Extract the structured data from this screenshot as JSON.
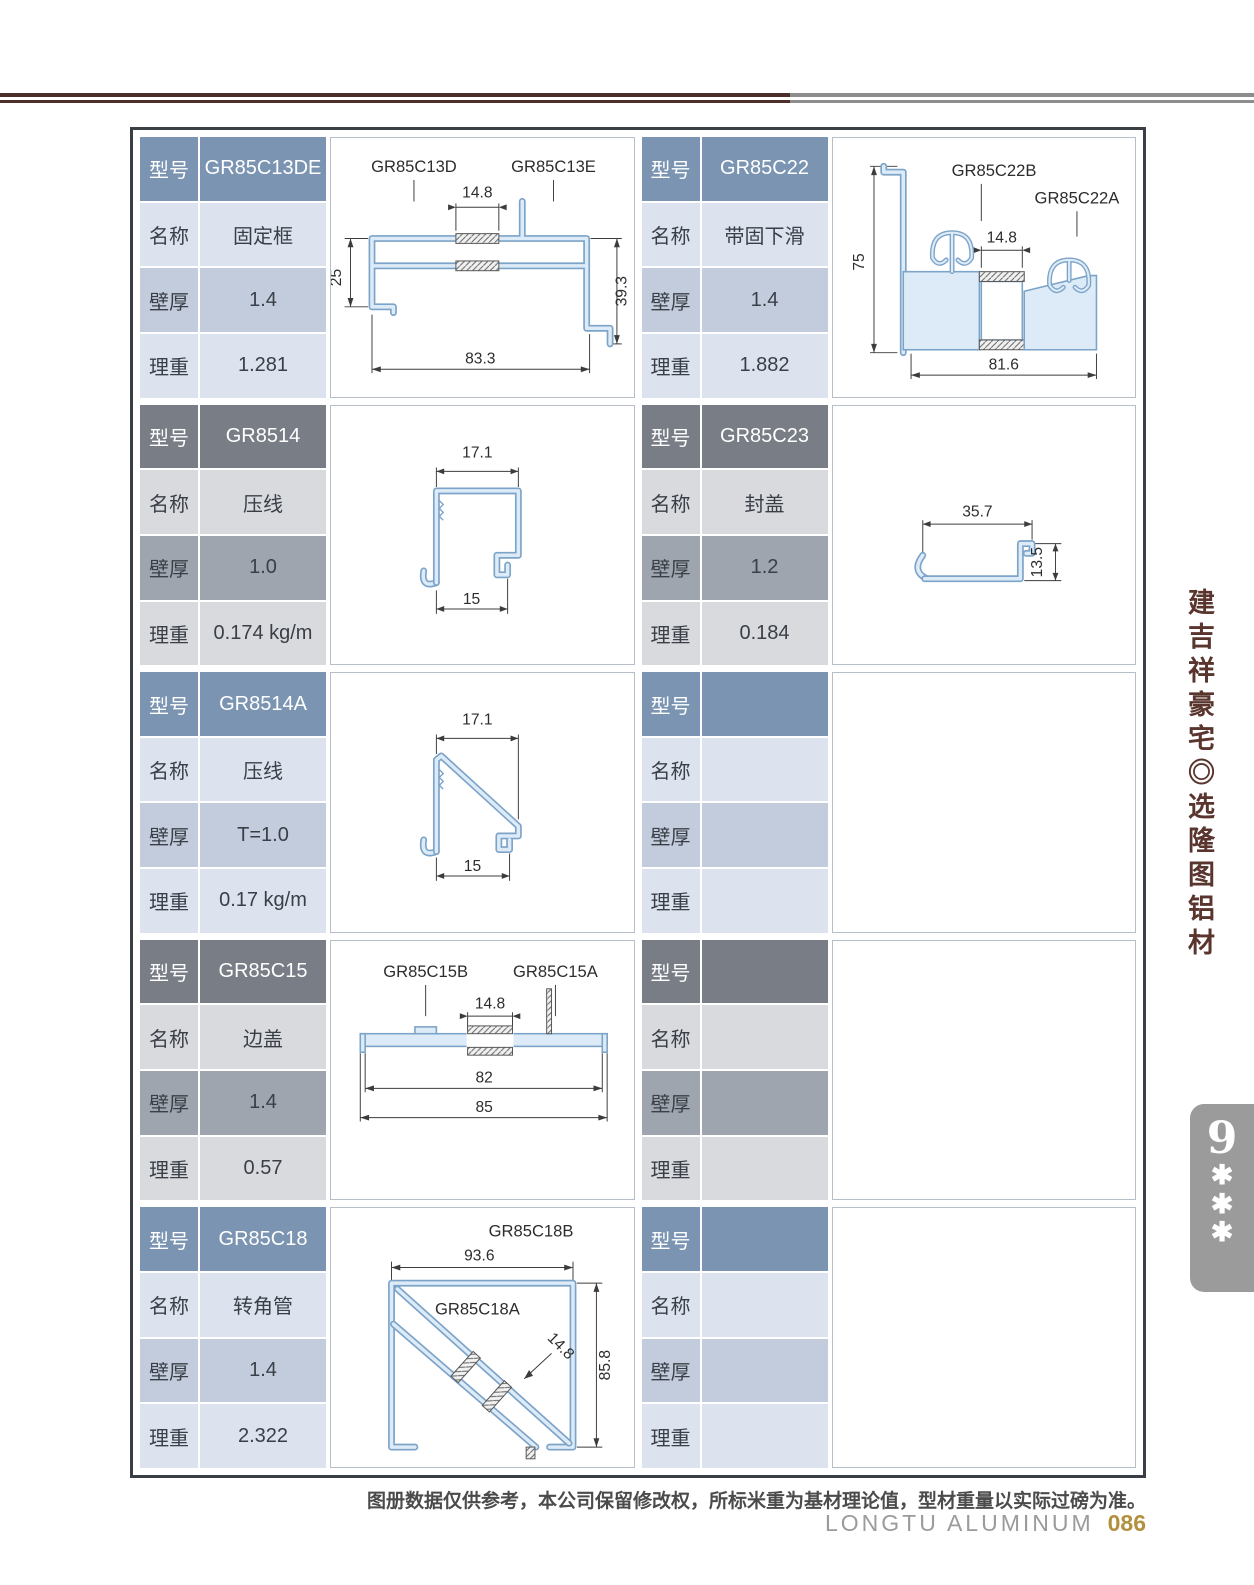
{
  "header": {
    "title_cn": "GR85C 系列隔热节能推拉窗型材图",
    "title_en": "GR85C series insulation energy-saving push-pull window profile graph",
    "brand_cn": "隆图",
    "brand_suffix": "节能铝材",
    "brand_en": "LONGTU ENERGY-SAVING ALUMINUM"
  },
  "labels": {
    "model": "型号",
    "name": "名称",
    "thickness": "壁厚",
    "weight": "理重"
  },
  "cells": [
    {
      "theme": "blue",
      "model": "GR85C13DE",
      "name": "固定框",
      "thickness": "1.4",
      "weight": "1.281",
      "drawing": {
        "label_left": "GR85C13D",
        "label_right": "GR85C13E",
        "dim_top": "14.8",
        "dim_left": "25",
        "dim_right": "39.3",
        "dim_bottom": "83.3"
      }
    },
    {
      "theme": "blue",
      "model": "GR85C22",
      "name": "带固下滑",
      "thickness": "1.4",
      "weight": "1.882",
      "drawing": {
        "label_left": "GR85C22B",
        "label_right": "GR85C22A",
        "dim_left": "75",
        "dim_mid": "14.8",
        "dim_bottom": "81.6"
      }
    },
    {
      "theme": "gray",
      "model": "GR8514",
      "name": "压线",
      "thickness": "1.0",
      "weight": "0.174 kg/m",
      "drawing": {
        "dim_top": "17.1",
        "dim_bottom": "15"
      }
    },
    {
      "theme": "gray",
      "model": "GR85C23",
      "name": "封盖",
      "thickness": "1.2",
      "weight": "0.184",
      "drawing": {
        "dim_top": "35.7",
        "dim_right": "13.5"
      }
    },
    {
      "theme": "blue",
      "model": "GR8514A",
      "name": "压线",
      "thickness": "T=1.0",
      "weight": "0.17 kg/m",
      "drawing": {
        "dim_top": "17.1",
        "dim_bottom": "15"
      }
    },
    {
      "theme": "blue",
      "model": "",
      "name": "",
      "thickness": "",
      "weight": "",
      "drawing": {}
    },
    {
      "theme": "gray",
      "model": "GR85C15",
      "name": "边盖",
      "thickness": "1.4",
      "weight": "0.57",
      "drawing": {
        "label_left": "GR85C15B",
        "label_right": "GR85C15A",
        "dim_mid": "14.8",
        "dim_inner": "82",
        "dim_bottom": "85"
      }
    },
    {
      "theme": "gray",
      "model": "",
      "name": "",
      "thickness": "",
      "weight": "",
      "drawing": {}
    },
    {
      "theme": "blue",
      "model": "GR85C18",
      "name": "转角管",
      "thickness": "1.4",
      "weight": "2.322",
      "drawing": {
        "label_top": "GR85C18B",
        "label_inner": "GR85C18A",
        "dim_top": "93.6",
        "dim_diag": "14.8",
        "dim_right": "85.8"
      }
    },
    {
      "theme": "blue",
      "model": "",
      "name": "",
      "thickness": "",
      "weight": "",
      "drawing": {}
    }
  ],
  "sidebar": {
    "slogan": "建吉祥豪宅◎选隆图铝材",
    "tab": {
      "number": "9",
      "star1": "✱",
      "star2": "✱",
      "star3": "✱"
    }
  },
  "footer": {
    "note": "图册数据仅供参考，本公司保留修改权，所标米重为基材理论值，型材重量以实际过磅为准。",
    "brand": "LONGTU ALUMINUM",
    "page": "086"
  }
}
